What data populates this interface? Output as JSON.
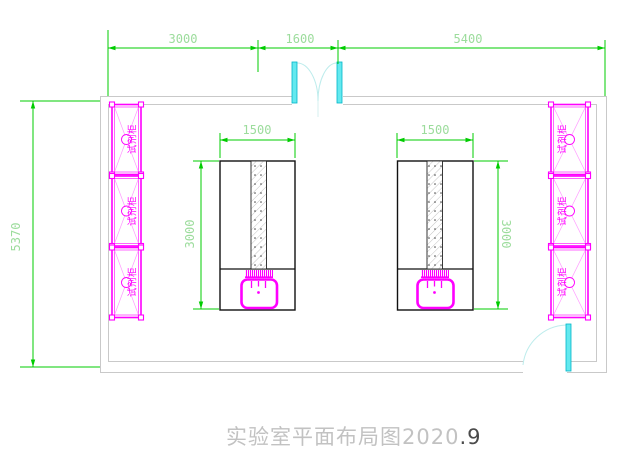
{
  "drawing_type": "laboratory floor plan (CAD)",
  "title": {
    "text": "实验室平面布局图2020",
    "suffix": ".9"
  },
  "dimensions": {
    "top": [
      {
        "label": "3000"
      },
      {
        "label": "1600"
      },
      {
        "label": "5400"
      }
    ],
    "room_height": {
      "label": "5370"
    },
    "left_table": {
      "width": {
        "label": "1500"
      },
      "height": {
        "label": "3000"
      }
    },
    "right_table": {
      "width": {
        "label": "1500"
      },
      "height": {
        "label": "3000"
      }
    }
  },
  "cabinets": {
    "left": [
      {
        "label": "试剂柜"
      },
      {
        "label": "试剂柜"
      },
      {
        "label": "试剂柜"
      }
    ],
    "right": [
      {
        "label": "试剂柜"
      },
      {
        "label": "试剂柜"
      },
      {
        "label": "试剂柜"
      }
    ]
  },
  "colors": {
    "dimension_line": "#00cc00",
    "dimension_text": "#9cdc9c",
    "fixture_magenta": "#ff00ff",
    "door_leaf_cyan": "#63e9ef",
    "door_arc": "#bdecec",
    "wall_gray": "#c9c9c9",
    "table_outline": "#111111",
    "title_gray": "#c2c2c2"
  }
}
